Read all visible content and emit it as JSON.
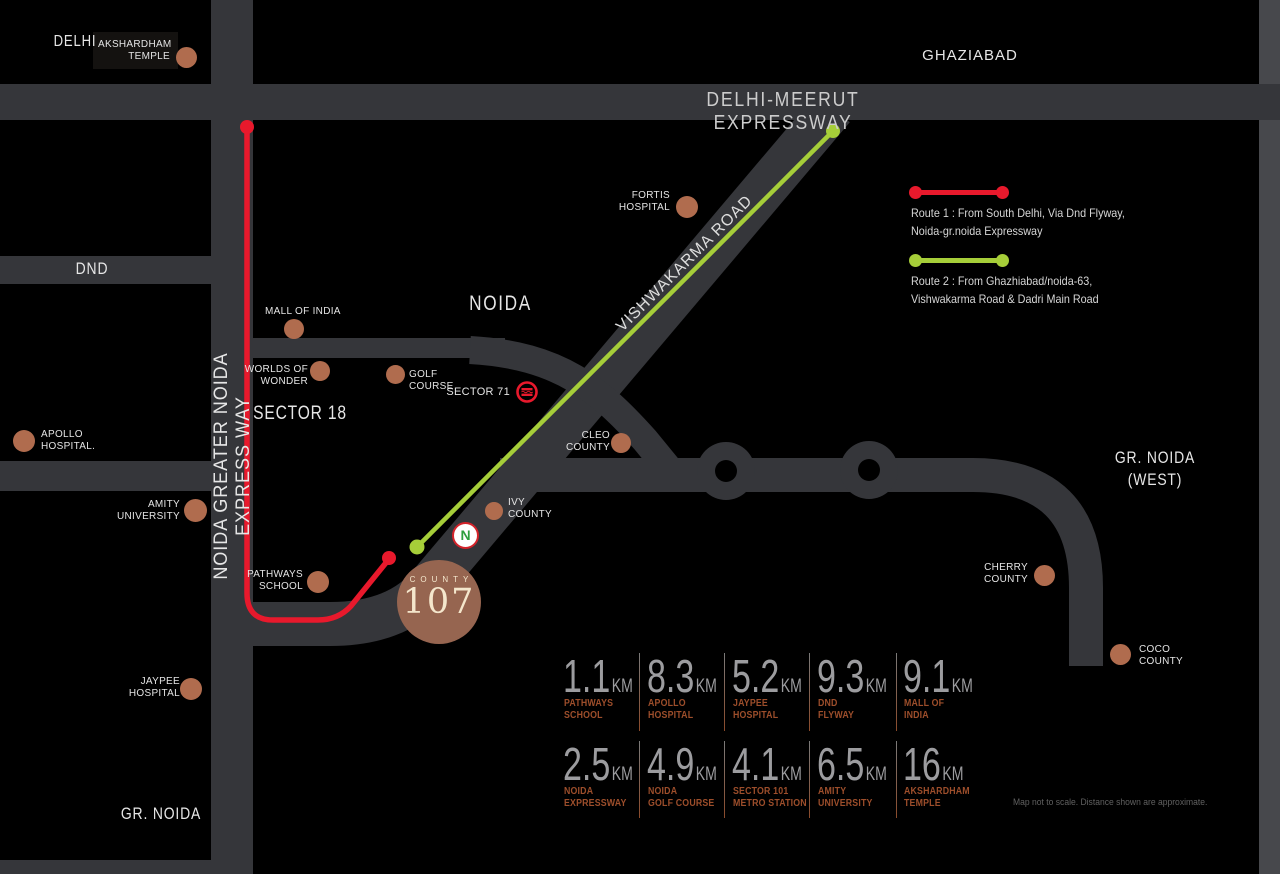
{
  "colors": {
    "background": "#000000",
    "road": "#35363a",
    "right_strip": "#47484c",
    "route_red": "#e8192c",
    "route_green": "#a6ce39",
    "landmark_dot": "#b06c4e",
    "logo_bg": "#966550",
    "logo_text": "#f4e6cc",
    "distance_number": "#9c9c9f",
    "distance_label": "#9d4e2b"
  },
  "cities": {
    "delhi": "DELHI",
    "ghaziabad": "GHAZIABAD",
    "noida": "NOIDA",
    "sector18": "SECTOR 18",
    "dnd": "DND",
    "gr_noida": "GR. NOIDA",
    "gr_noida_west_line1": "GR. NOIDA",
    "gr_noida_west_line2": "(WEST)"
  },
  "road_labels": {
    "delhi_meerut": "DELHI-MEERUT EXPRESSWAY",
    "noida_greater": "NOIDA GREATER NOIDA EXPRESS WAY",
    "vishwakarma": "VISHWAKARMA ROAD"
  },
  "landmarks": {
    "akshardham": {
      "line1": "AKSHARDHAM",
      "line2": "TEMPLE"
    },
    "fortis": {
      "line1": "FORTIS",
      "line2": "HOSPITAL"
    },
    "mall_of_india": {
      "line1": "MALL OF INDIA"
    },
    "worlds_of_wonder": {
      "line1": "WORLDS OF",
      "line2": "WONDER"
    },
    "golf_course": {
      "line1": "GOLF",
      "line2": "COURSE"
    },
    "sector71": {
      "line1": "SECTOR 71"
    },
    "cleo_county": {
      "line1": "CLEO",
      "line2": "COUNTY"
    },
    "apollo": {
      "line1": "APOLLO",
      "line2": "HOSPITAL."
    },
    "amity": {
      "line1": "AMITY",
      "line2": "UNIVERSITY"
    },
    "ivy_county": {
      "line1": "IVY",
      "line2": "COUNTY"
    },
    "pathways": {
      "line1": "PATHWAYS",
      "line2": "SCHOOL"
    },
    "jaypee": {
      "line1": "JAYPEE",
      "line2": "HOSPITAL"
    },
    "cherry_county": {
      "line1": "CHERRY",
      "line2": "COUNTY"
    },
    "coco_county": {
      "line1": "COCO",
      "line2": "COUNTY"
    }
  },
  "legend": {
    "route1_line1": "Route 1 : From South Delhi, Via Dnd Flyway,",
    "route1_line2": "Noida-gr.noida Expressway",
    "route2_line1": "Route 2 : From Ghazhiabad/noida-63,",
    "route2_line2": "Vishwakarma Road & Dadri Main Road"
  },
  "logo": {
    "brand": "COUNTY",
    "number": "107"
  },
  "badge_n": "N",
  "distances": {
    "unit": "KM",
    "rows": [
      [
        {
          "value": "1.1",
          "line1": "PATHWAYS",
          "line2": "SCHOOL"
        },
        {
          "value": "8.3",
          "line1": "APOLLO",
          "line2": "HOSPITAL"
        },
        {
          "value": "5.2",
          "line1": "JAYPEE",
          "line2": "HOSPITAL"
        },
        {
          "value": "9.3",
          "line1": "DND",
          "line2": "FLYWAY"
        },
        {
          "value": "9.1",
          "line1": "MALL OF",
          "line2": "INDIA"
        }
      ],
      [
        {
          "value": "2.5",
          "line1": "NOIDA",
          "line2": "EXPRESSWAY"
        },
        {
          "value": "4.9",
          "line1": "NOIDA",
          "line2": "GOLF COURSE"
        },
        {
          "value": "4.1",
          "line1": "SECTOR 101",
          "line2": "METRO STATION"
        },
        {
          "value": "6.5",
          "line1": "AMITY",
          "line2": "UNIVERSITY"
        },
        {
          "value": "16",
          "line1": "AKSHARDHAM",
          "line2": "TEMPLE"
        }
      ]
    ]
  },
  "disclaimer": "Map not to scale. Distance shown are approximate."
}
